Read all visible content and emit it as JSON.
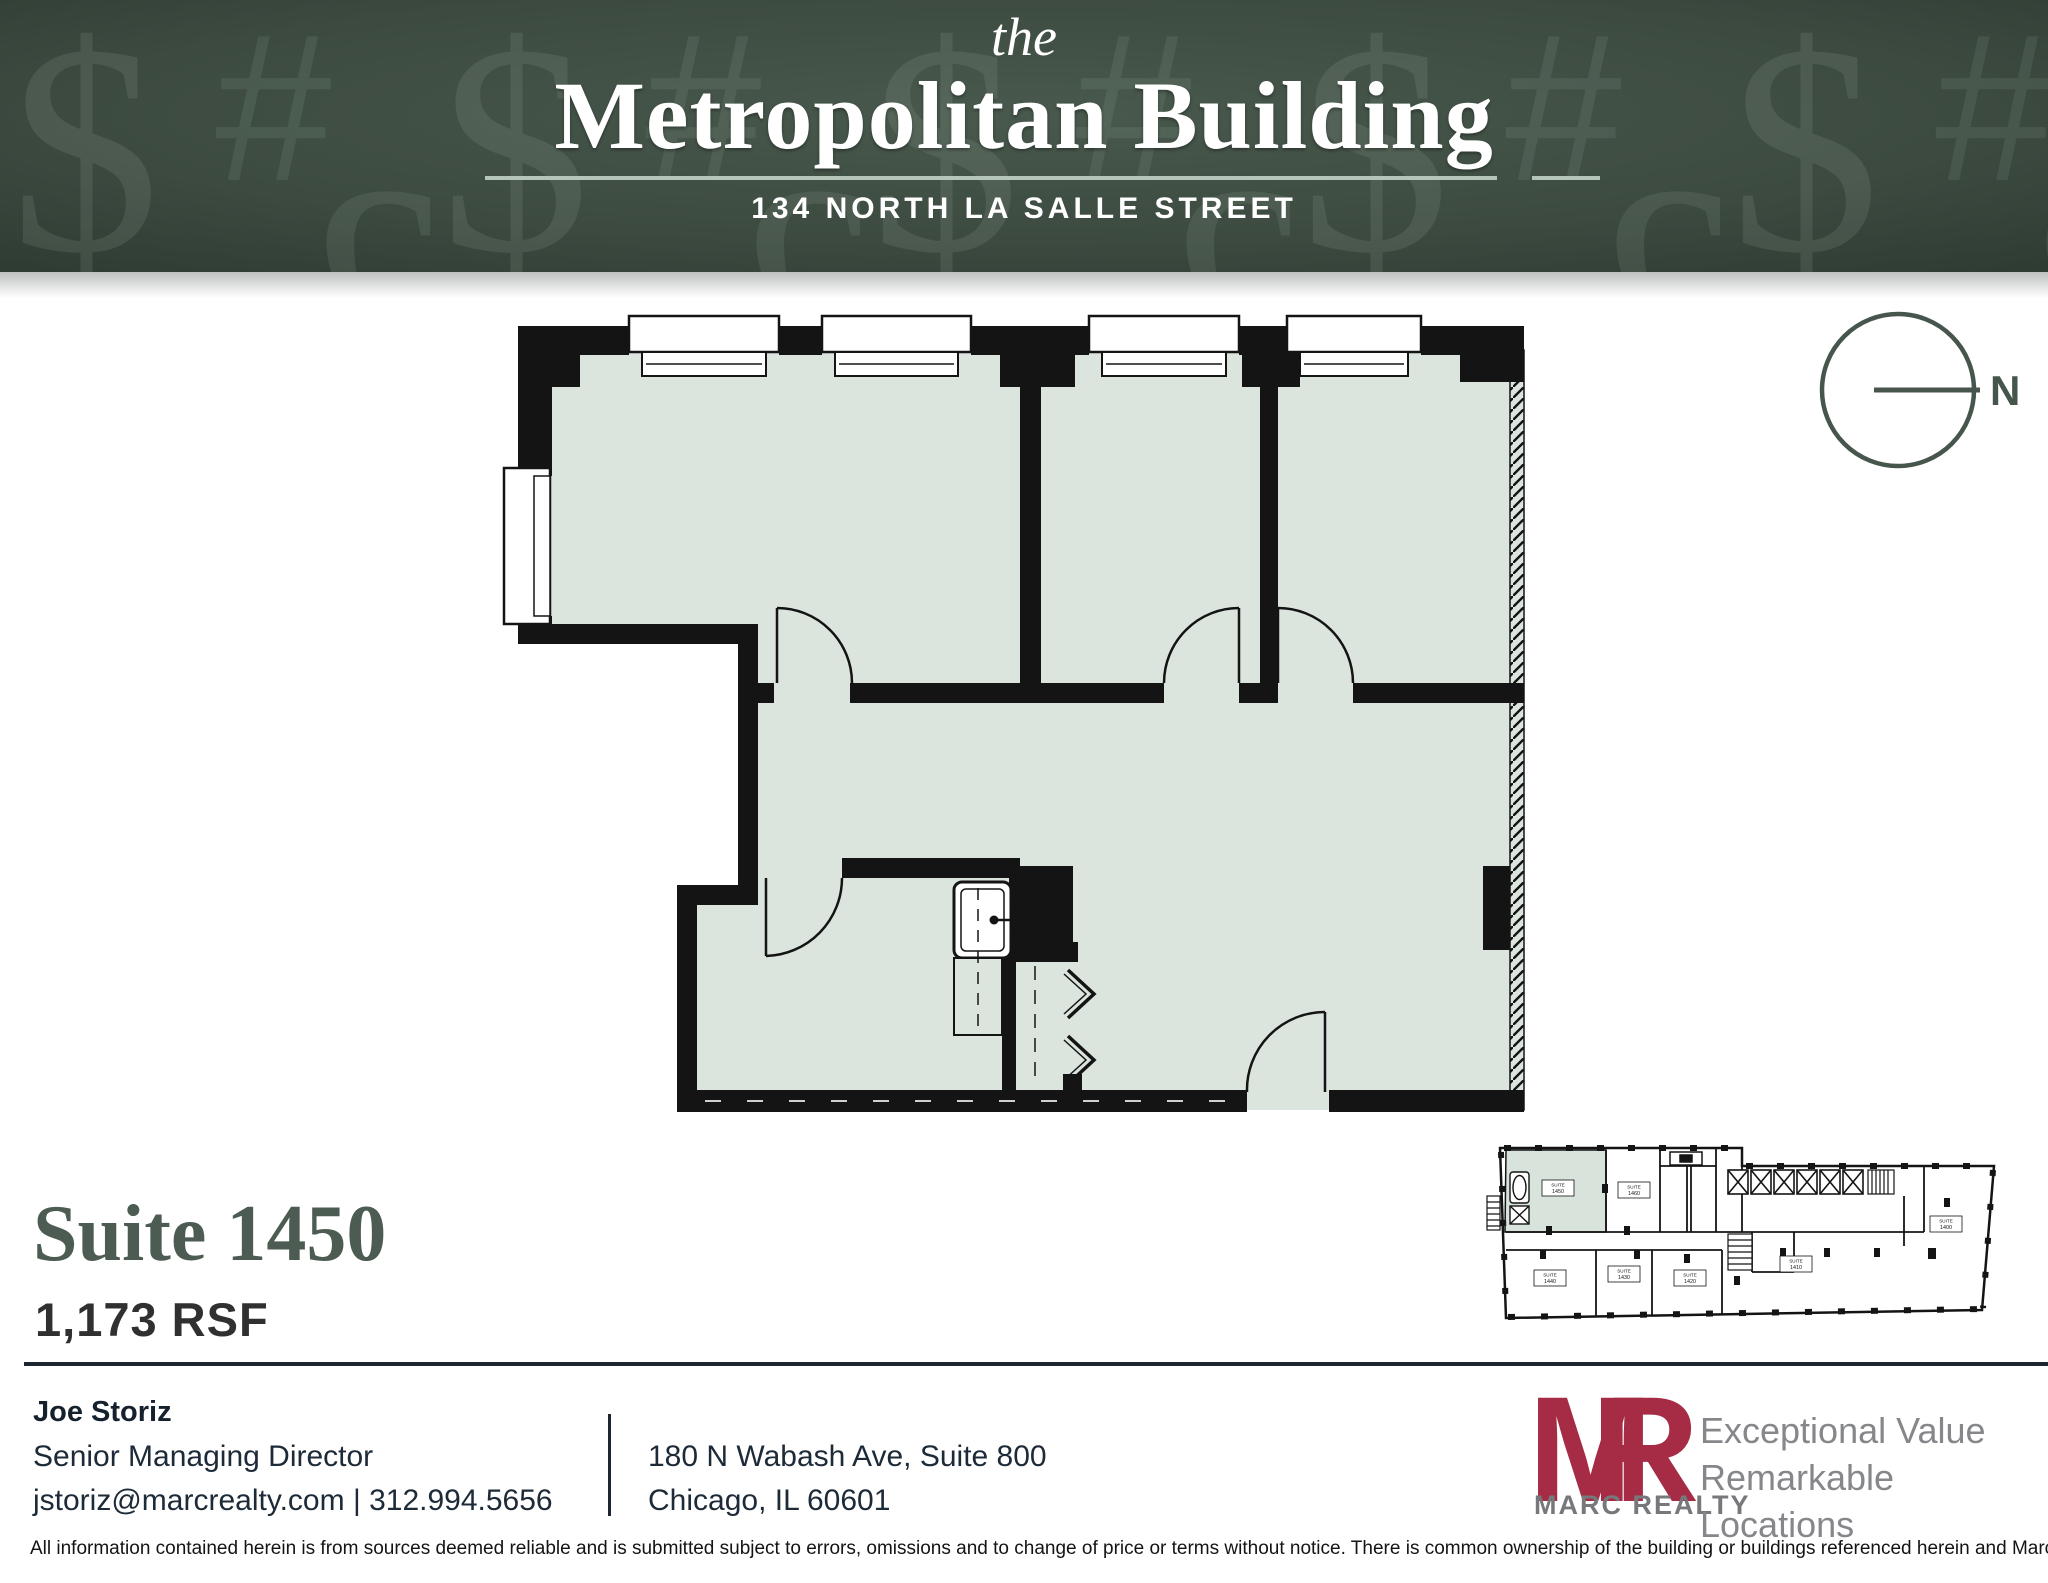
{
  "header": {
    "pre_title": "the",
    "title": "Metropolitan Building",
    "address": "134 NORTH LA SALLE STREET"
  },
  "compass": {
    "label": "N"
  },
  "suite": {
    "name": "Suite 1450",
    "area": "1,173 RSF"
  },
  "contact": {
    "name": "Joe Storiz",
    "title": "Senior Managing Director",
    "email": "jstoriz@marcrealty.com",
    "separator": "|",
    "phone": "312.994.5656"
  },
  "office_address": {
    "line1": "180 N Wabash Ave, Suite 800",
    "line2": "Chicago, IL 60601"
  },
  "brand": {
    "monogram_m": "M",
    "monogram_r": "R",
    "name": "MARC REALTY",
    "tagline_line1": "Exceptional Value",
    "tagline_line2": "Remarkable Locations"
  },
  "disclaimer": "All information contained herein is from sources deemed reliable and is submitted subject to errors, omissions and to change of price or terms without notice. There is common ownership of the building or buildings referenced herein and Marc Realty LLC.TW",
  "keyplan": {
    "label_word": "SUITE",
    "suites": [
      "1450",
      "1460",
      "1440",
      "1430",
      "1420",
      "1410",
      "1400"
    ]
  },
  "colors": {
    "header_green": "#3a473d",
    "pattern_glyph": "#a9bcac",
    "underline_sage": "#b5c6b8",
    "floor_fill": "#dbe5de",
    "wall_black": "#141414",
    "title_green": "#4d5c52",
    "rule_navy": "#1d2531",
    "brand_maroon": "#a62b45",
    "brand_gray": "#77787b"
  }
}
